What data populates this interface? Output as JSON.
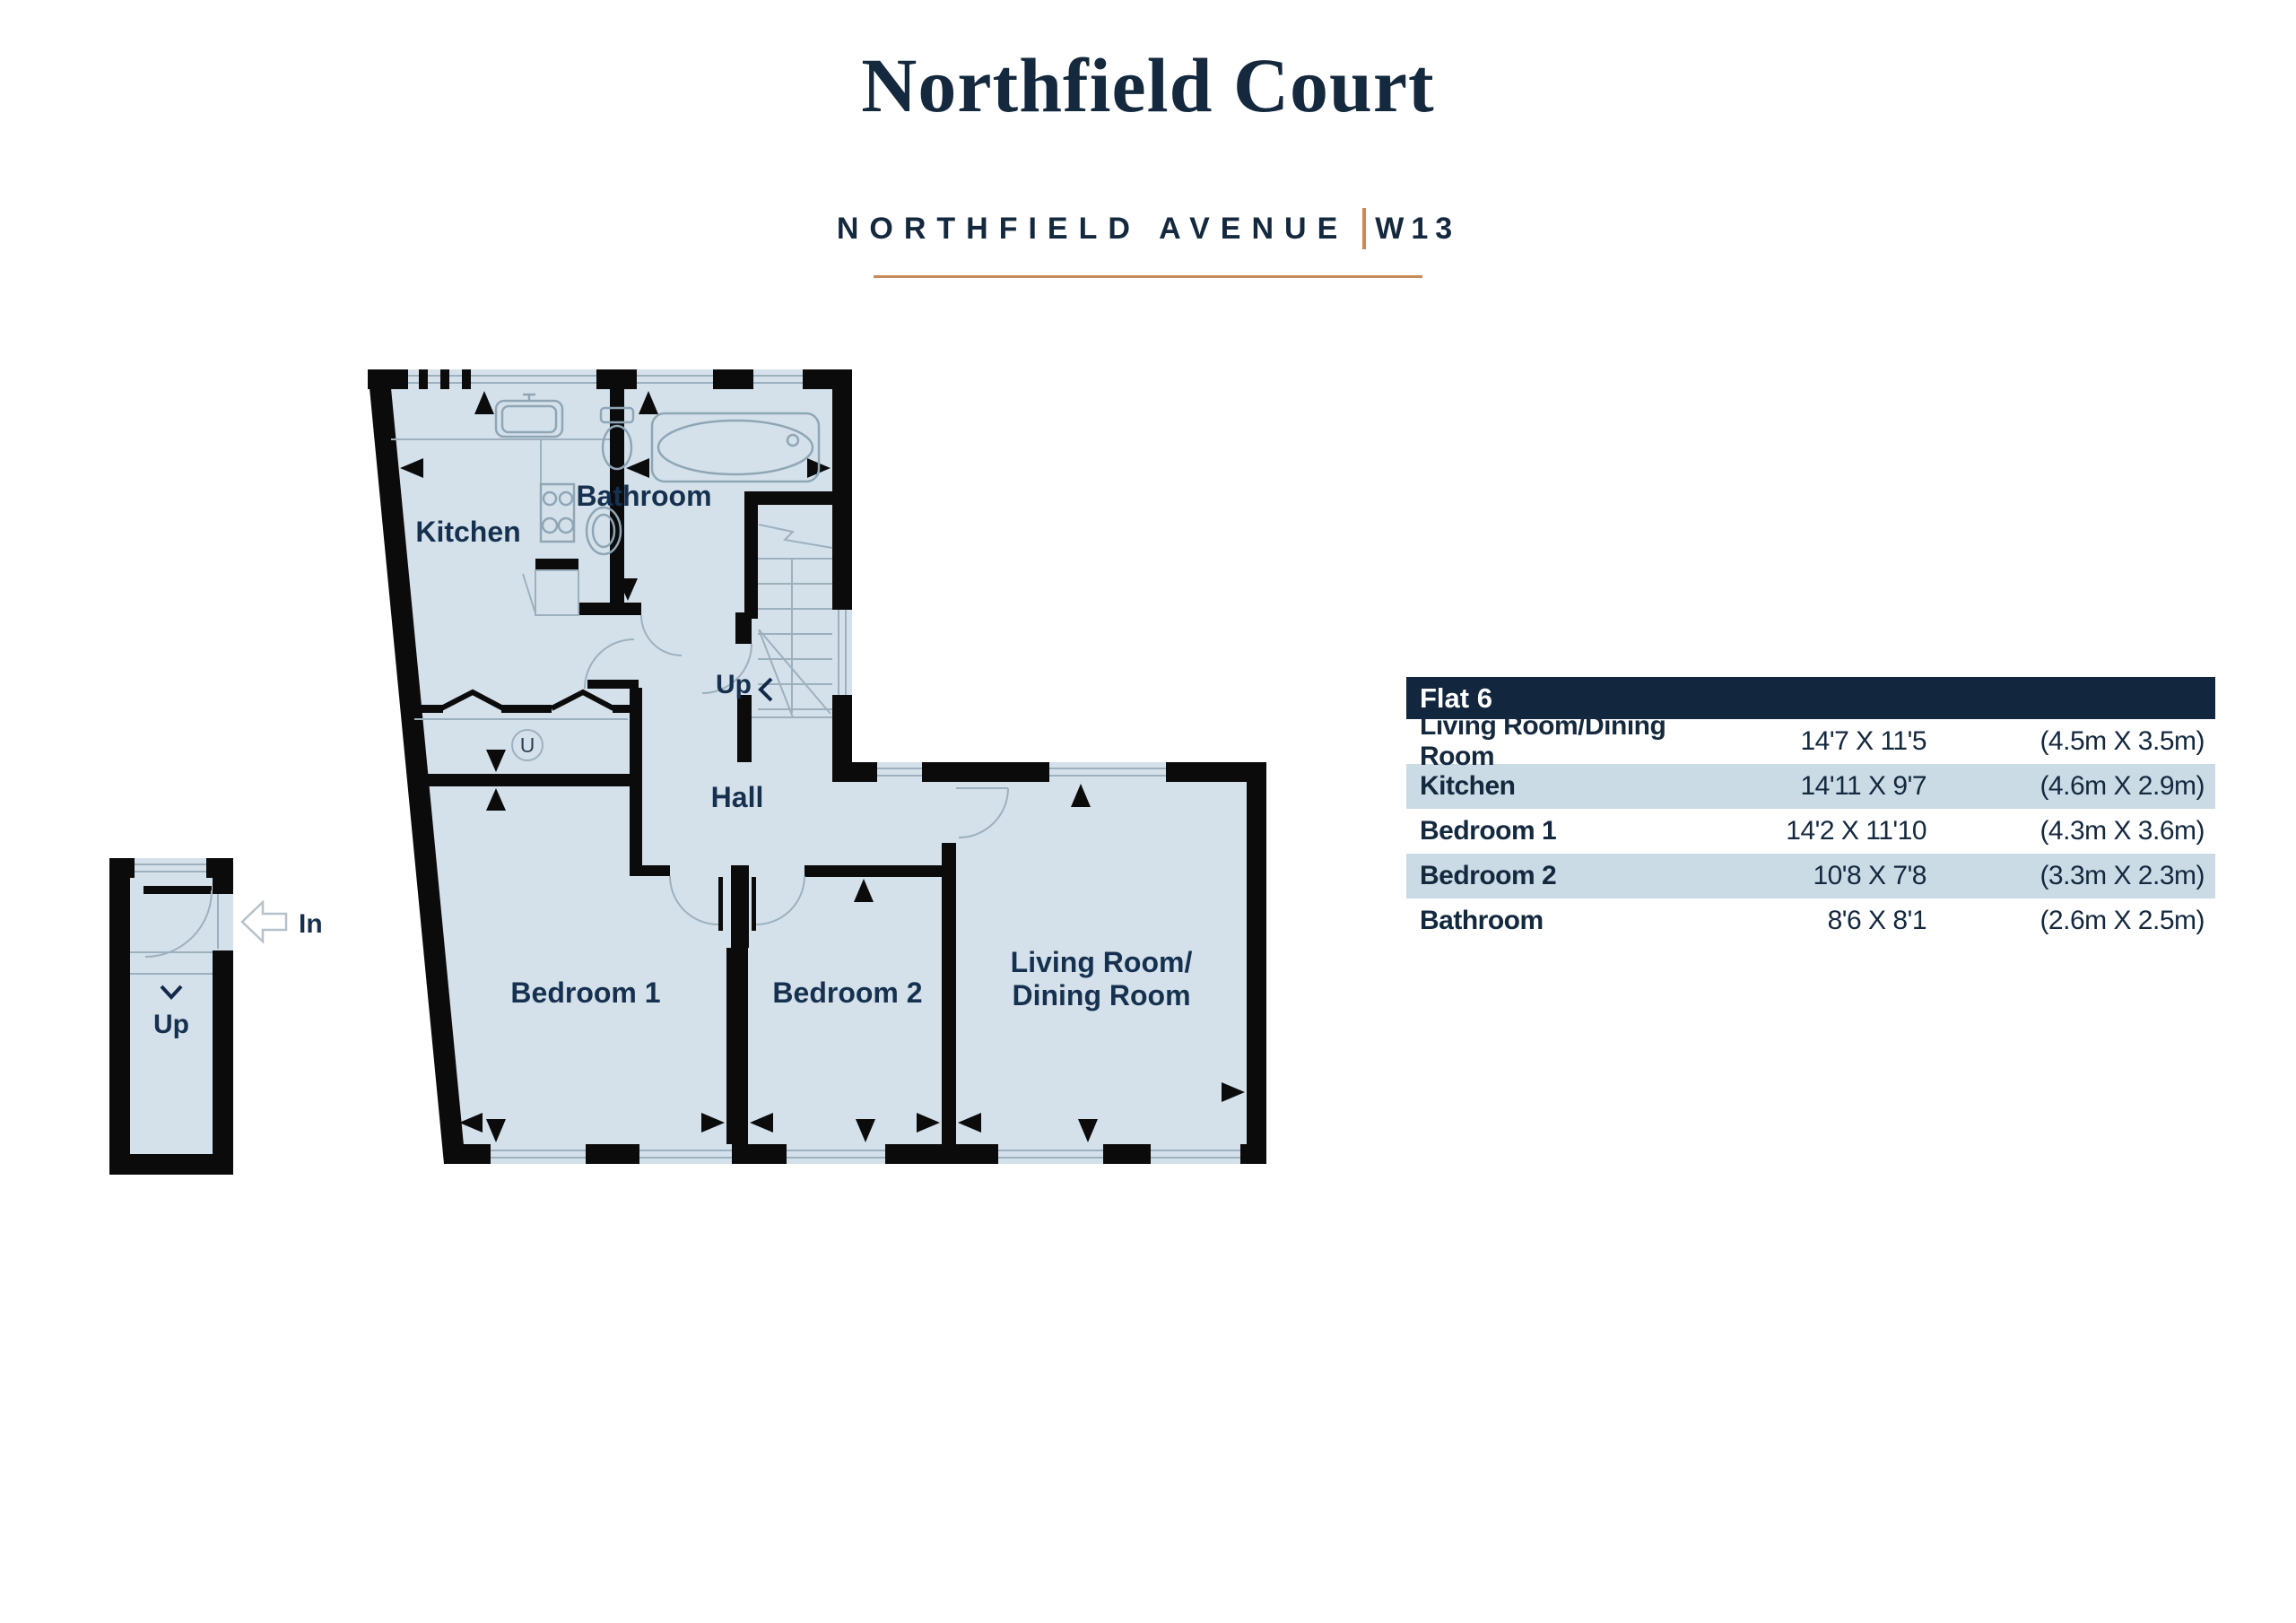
{
  "header": {
    "title": "Northfield Court",
    "street": "NORTHFIELD AVENUE",
    "postcode": "W13",
    "accent_color": "#c9885a",
    "navy_color": "#14283e"
  },
  "floorplan": {
    "labels": {
      "kitchen": "Kitchen",
      "bathroom": "Bathroom",
      "hall": "Hall",
      "bedroom1": "Bedroom 1",
      "bedroom2": "Bedroom 2",
      "living_line1": "Living Room/",
      "living_line2": "Dining Room",
      "stairs_up": "Up",
      "lobby_up": "Up",
      "entrance_in": "In",
      "utility": "U"
    },
    "colors": {
      "floor": "#d5e1ea",
      "wall": "#0b0b0c",
      "detail_line": "#9db0be",
      "label_text": "#16314f"
    }
  },
  "table": {
    "title": "Flat 6",
    "colors": {
      "header_bg": "#12263e",
      "header_text": "#ffffff",
      "row_alt_bg": "#cbdbe6",
      "row_bg": "#ffffff",
      "text": "#14283e"
    },
    "rows": [
      {
        "name": "Living Room/Dining Room",
        "imperial": "14'7 X 11'5",
        "metric": "(4.5m X 3.5m)"
      },
      {
        "name": "Kitchen",
        "imperial": "14'11 X 9'7",
        "metric": "(4.6m X 2.9m)"
      },
      {
        "name": "Bedroom 1",
        "imperial": "14'2 X 11'10",
        "metric": "(4.3m X 3.6m)"
      },
      {
        "name": "Bedroom 2",
        "imperial": "10'8 X 7'8",
        "metric": "(3.3m X 2.3m)"
      },
      {
        "name": "Bathroom",
        "imperial": "8'6 X 8'1",
        "metric": "(2.6m X 2.5m)"
      }
    ]
  }
}
